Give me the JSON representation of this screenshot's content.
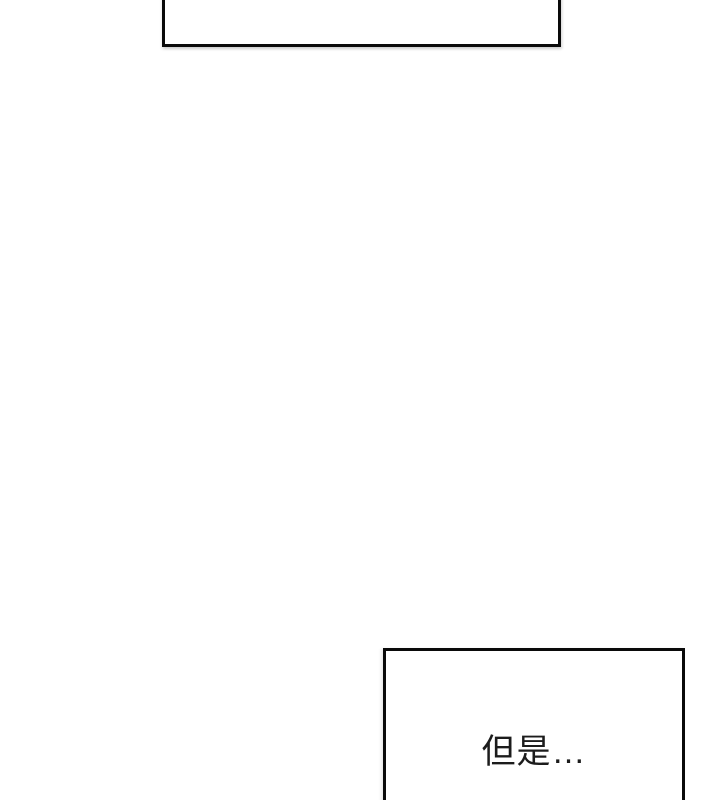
{
  "panels": {
    "top_panel": {
      "caption": ""
    },
    "bottom_panel": {
      "caption": "但是…"
    }
  },
  "colors": {
    "background": "#ffffff",
    "panel_fill": "#ffffff",
    "panel_border": "#0a0a0a",
    "caption_text": "#1c1c1c"
  }
}
